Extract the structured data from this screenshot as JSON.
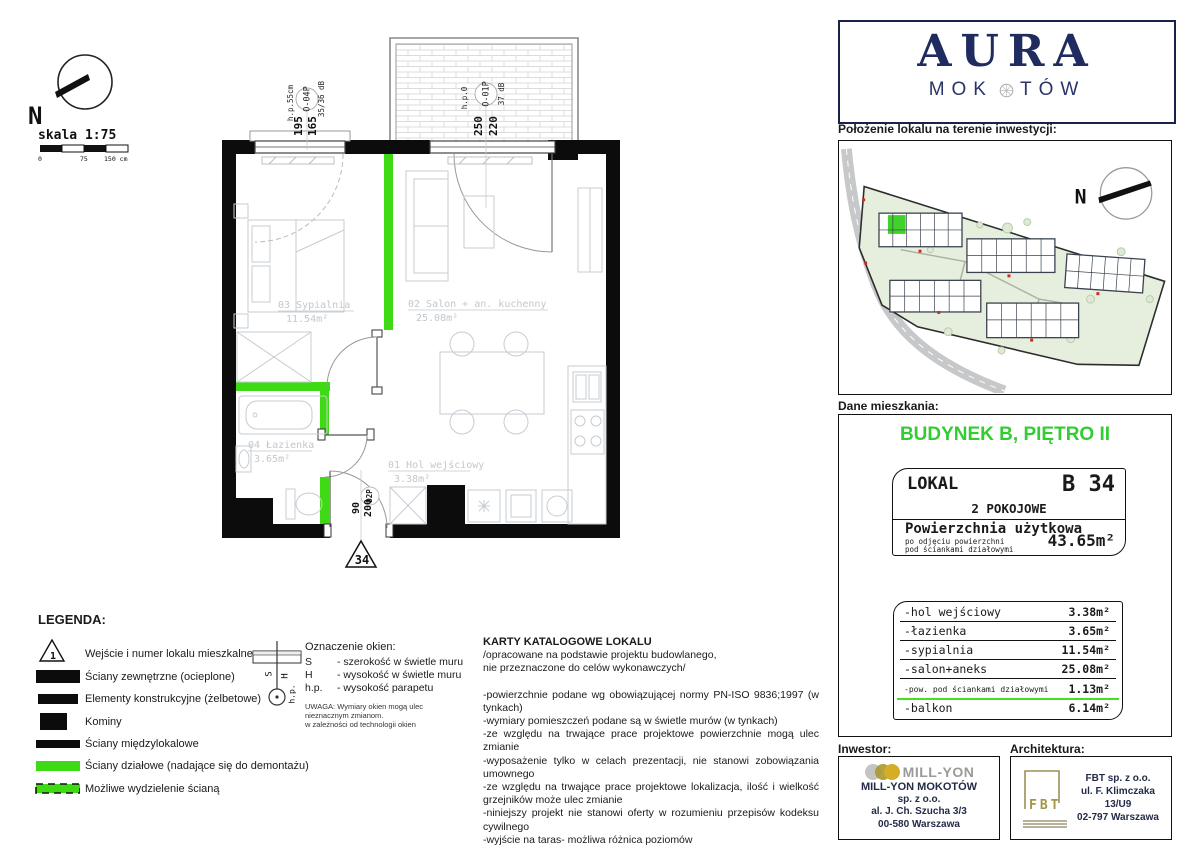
{
  "compass": {
    "north": "N",
    "scale": "skala 1:75",
    "tick0": "0",
    "tick75": "75",
    "tick150": "150 cm"
  },
  "floor_plan": {
    "windows": [
      {
        "id": "O-04P",
        "db": "35/36 dB",
        "sill": "h.p.55cm",
        "dim_outer": "195",
        "dim_inner": "165"
      },
      {
        "id": "O-01P",
        "db": "37 dB",
        "sill": "h.p.0",
        "dim_outer": "250",
        "dim_inner": "220"
      }
    ],
    "entry_door": {
      "id": "D2P",
      "w": "90",
      "h": "200"
    },
    "unit_number": "34",
    "rooms": [
      {
        "name": "03 Sypialnia",
        "area": "11.54m²"
      },
      {
        "name": "02 Salon + an. kuchenny",
        "area": "25.08m²"
      },
      {
        "name": "04 Łazienka",
        "area": "3.65m²"
      },
      {
        "name": "01 Hol wejściowy",
        "area": "3.38m²"
      }
    ]
  },
  "legend": {
    "title": "LEGENDA:",
    "entry_number": "1",
    "items": [
      "Wejście i numer lokalu mieszkalnego",
      "Ściany zewnętrzne (ocieplone)",
      "Elementy konstrukcyjne (żelbetowe)",
      "Kominy",
      "Ściany międzylokalowe",
      "Ściany działowe (nadające się do demontażu)",
      "Możliwe wydzielenie ścianą"
    ]
  },
  "window_key": {
    "title": "Oznaczenie okien:",
    "s_sym": "S",
    "s_desc": "- szerokość w świetle muru",
    "h_sym": "H",
    "h_desc": "- wysokość w świetle muru",
    "hp_sym": "h.p.",
    "hp_desc": "- wysokość parapetu",
    "note1": "UWAGA: Wymiary okien mogą ulec",
    "note2": "nieznacznym zmianom.",
    "note3": "w zależności od technologii okien",
    "diag_s": "S",
    "diag_h": "H",
    "diag_hp": "h.p."
  },
  "catalog": {
    "title": "KARTY KATALOGOWE LOKALU",
    "sub1": "/opracowane na podstawie projektu budowlanego,",
    "sub2": "nie przeznaczone do celów wykonawczych/",
    "bullets": [
      "-powierzchnie podane wg obowiązującej normy PN-ISO 9836;1997 (w tynkach)",
      "-wymiary pomieszczeń podane są w świetle murów (w tynkach)",
      "-ze względu na trwające prace projektowe powierzchnie mogą ulec zmianie",
      "-wyposażenie tylko w celach prezentacji, nie stanowi zobowiązania umownego",
      "-ze względu na trwające prace projektowe lokalizacja, ilość i wielkość grzejników może ulec zmianie",
      "-niniejszy projekt nie stanowi oferty w rozumieniu przepisów kodeksu cywilnego",
      "-wyjście na taras- możliwa różnica poziomów",
      "-na wszystkie zmieny należy uzyskać zgodę projektanta",
      "-wysokość mieszkania wynosi około 2,7m"
    ]
  },
  "brand": {
    "name": "AURA",
    "sub_left": "MOK",
    "sub_right": "TÓW",
    "location_title": "Położenie lokalu na terenie inwestycji:",
    "site_north": "N"
  },
  "apartment": {
    "section": "Dane mieszkania:",
    "building": "BUDYNEK B, PIĘTRO II",
    "lokal_label": "LOKAL",
    "unit": "B 34",
    "type": "2 POKOJOWE",
    "area_title": "Powierzchnia użytkowa",
    "area_sub1": "po odjęciu powierzchni",
    "area_sub2": "pod ściankami działowymi",
    "area_value": "43.65m²",
    "rows": [
      {
        "name": "-hol wejściowy",
        "val": "3.38m²"
      },
      {
        "name": "-łazienka",
        "val": "3.65m²"
      },
      {
        "name": "-sypialnia",
        "val": "11.54m²"
      },
      {
        "name": "-salon+aneks",
        "val": "25.08m²"
      },
      {
        "name": "-pow. pod ściankami działowymi",
        "val": "1.13m²"
      },
      {
        "name": "-balkon",
        "val": "6.14m²"
      }
    ]
  },
  "footer": {
    "investor_label": "Inwestor:",
    "arch_label": "Architektura:",
    "investor": {
      "logo": "MILL-YON",
      "l1": "MILL-YON MOKOTÓW",
      "l2": "sp. z o.o.",
      "l3": "al. J. Ch. Szucha 3/3",
      "l4": "00-580 Warszawa"
    },
    "architect": {
      "logo": "FBT",
      "l1": "FBT sp. z o.o.",
      "l2": "ul. F. Klimczaka 13/U9",
      "l3": "02-797 Warszawa"
    }
  },
  "colors": {
    "wall_green": "#3edb14",
    "heading_green": "#33cc33",
    "navy": "#202b60"
  }
}
